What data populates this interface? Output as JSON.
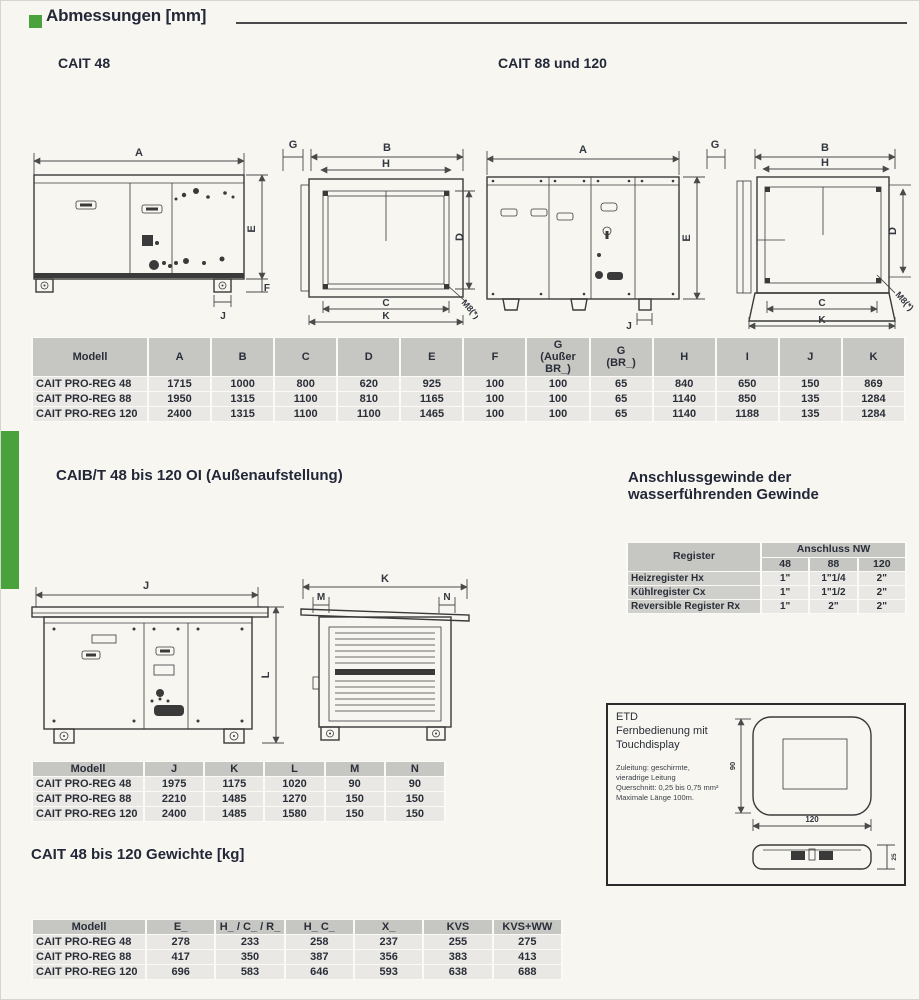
{
  "colors": {
    "accent_green": "#4aa23c"
  },
  "headings": {
    "main": "Abmessungen [mm]",
    "cait48": "CAIT 48",
    "cait88": "CAIT 88 und 120",
    "caibt": "CAIB/T 48 bis 120 OI (Außenaufstellung)",
    "thread": "Anschlussgewinde der\nwasserführenden Gewinde",
    "weights": "CAIT 48 bis 120 Gewichte [kg]"
  },
  "drawings": {
    "cait48_side": {
      "A": "A",
      "E": "E",
      "F": "F",
      "J": "J"
    },
    "cait48_front": {
      "G": "G",
      "B": "B",
      "H": "H",
      "D": "D",
      "C": "C",
      "K": "K",
      "M8": "M8(*)"
    },
    "cait88_side": {
      "A": "A",
      "E": "E",
      "J": "J"
    },
    "cait88_front": {
      "G": "G",
      "B": "B",
      "H": "H",
      "D": "D",
      "C": "C",
      "K": "K",
      "M8": "M8(*)"
    },
    "caibt_side": {
      "J": "J",
      "L": "L"
    },
    "caibt_front": {
      "K": "K",
      "M": "M",
      "N": "N"
    },
    "etd": {
      "title": "ETD",
      "line1": "Fernbedienung mit",
      "line2": "Touchdisplay",
      "note": "Zuleitung: geschirmte,\nvieradrige Leitung\nQuerschnitt: 0,25 bis 0,75 mm²\nMaximale Länge 100m.",
      "dim_height": "90",
      "dim_width": "120",
      "dim_depth": "25"
    }
  },
  "dim_table": {
    "headers": [
      "Modell",
      "A",
      "B",
      "C",
      "D",
      "E",
      "F",
      "G\n(Außer\nBR_)",
      "G\n(BR_)",
      "H",
      "I",
      "J",
      "K"
    ],
    "rows": [
      [
        "CAIT PRO-REG 48",
        "1715",
        "1000",
        "800",
        "620",
        "925",
        "100",
        "100",
        "65",
        "840",
        "650",
        "150",
        "869"
      ],
      [
        "CAIT PRO-REG 88",
        "1950",
        "1315",
        "1100",
        "810",
        "1165",
        "100",
        "100",
        "65",
        "1140",
        "850",
        "135",
        "1284"
      ],
      [
        "CAIT PRO-REG 120",
        "2400",
        "1315",
        "1100",
        "1100",
        "1465",
        "100",
        "100",
        "65",
        "1140",
        "1188",
        "135",
        "1284"
      ]
    ]
  },
  "thread_table": {
    "col_header": "Register",
    "group_header": "Anschluss NW",
    "sizes": [
      "48",
      "88",
      "120"
    ],
    "rows": [
      [
        "Heizregister Hx",
        "1\"",
        "1\"1/4",
        "2\""
      ],
      [
        "Kühlregister Cx",
        "1\"",
        "1\"1/2",
        "2\""
      ],
      [
        "Reversible Register Rx",
        "1\"",
        "2\"",
        "2\""
      ]
    ]
  },
  "outdoor_table": {
    "headers": [
      "Modell",
      "J",
      "K",
      "L",
      "M",
      "N"
    ],
    "rows": [
      [
        "CAIT PRO-REG 48",
        "1975",
        "1175",
        "1020",
        "90",
        "90"
      ],
      [
        "CAIT PRO-REG 88",
        "2210",
        "1485",
        "1270",
        "150",
        "150"
      ],
      [
        "CAIT PRO-REG 120",
        "2400",
        "1485",
        "1580",
        "150",
        "150"
      ]
    ]
  },
  "weight_table": {
    "headers": [
      "Modell",
      "E_",
      "H_ / C_ / R_",
      "H_ C_",
      "X_",
      "KVS",
      "KVS+WW"
    ],
    "rows": [
      [
        "CAIT PRO-REG 48",
        "278",
        "233",
        "258",
        "237",
        "255",
        "275"
      ],
      [
        "CAIT PRO-REG 88",
        "417",
        "350",
        "387",
        "356",
        "383",
        "413"
      ],
      [
        "CAIT PRO-REG 120",
        "696",
        "583",
        "646",
        "593",
        "638",
        "688"
      ]
    ]
  }
}
